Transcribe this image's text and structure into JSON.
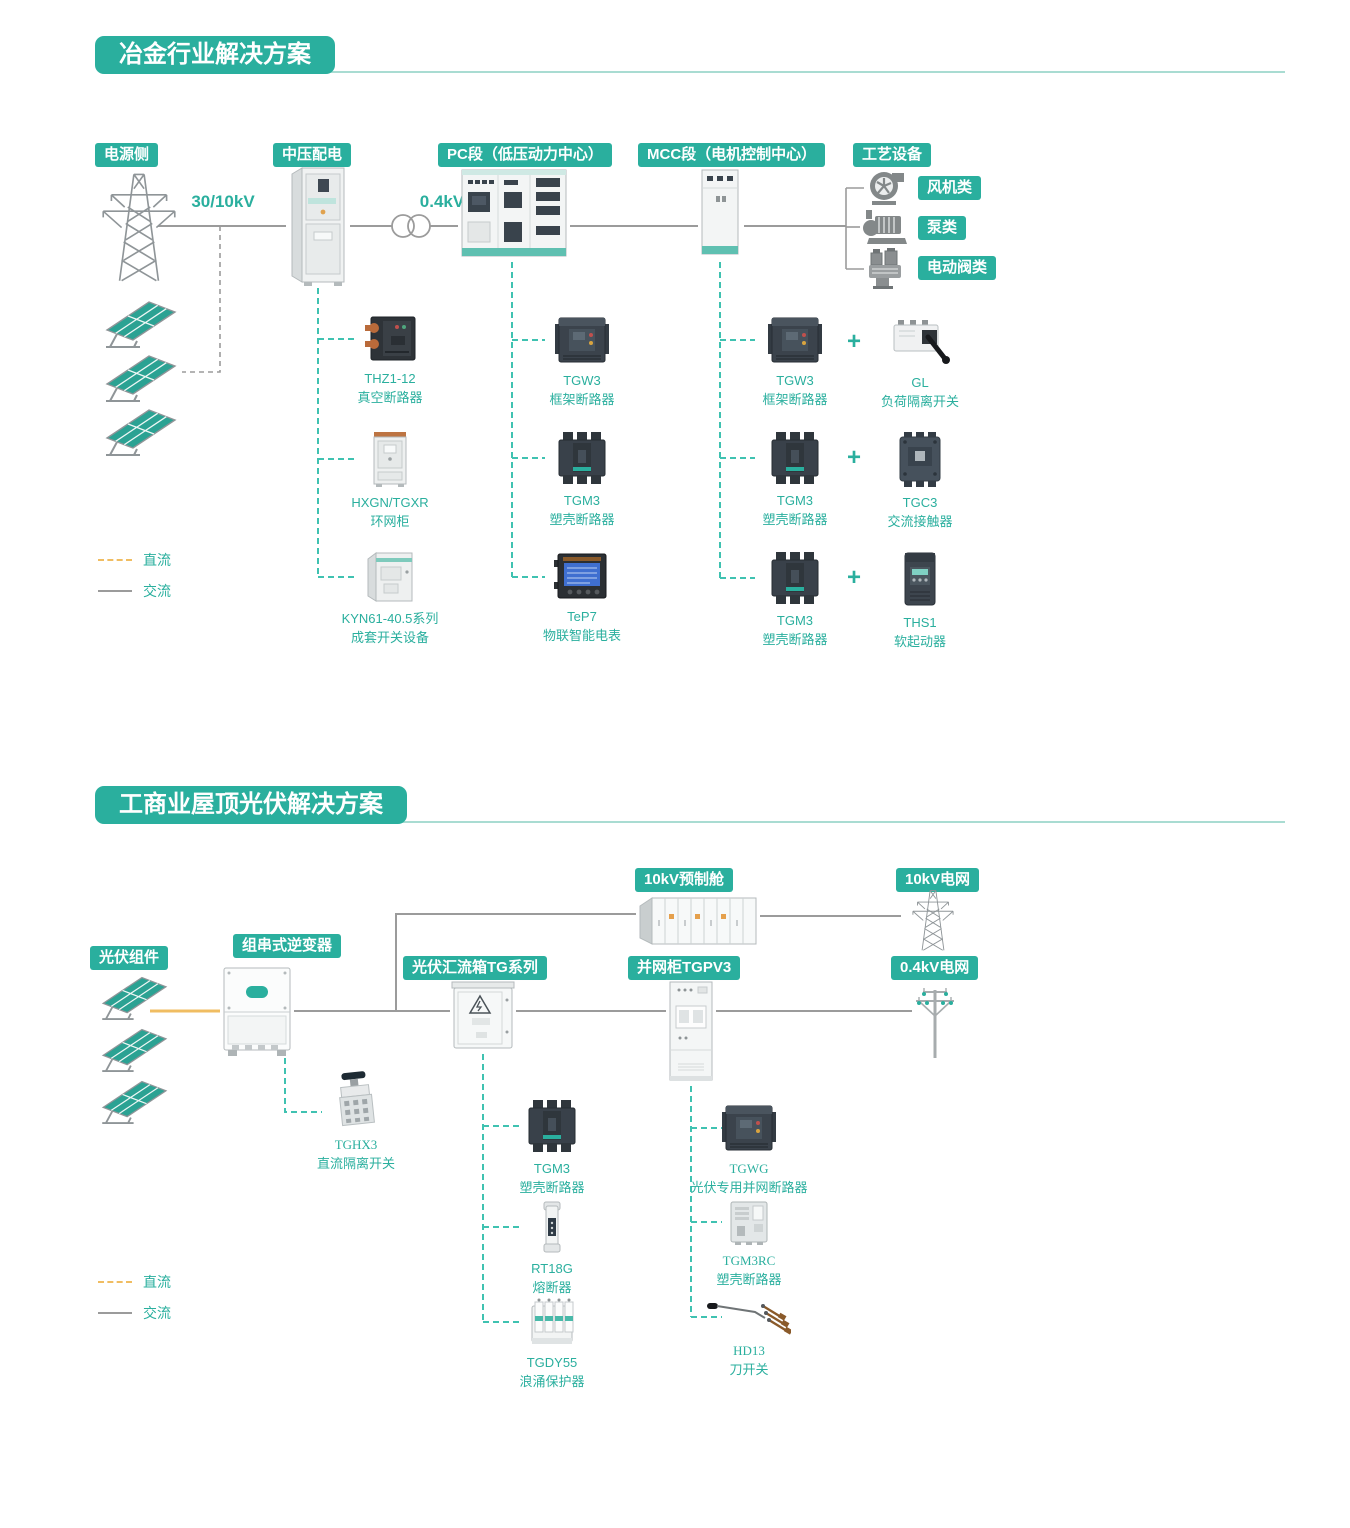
{
  "colors": {
    "brand_teal": "#2aaf9e",
    "dashed_teal": "#3fc2b1",
    "dc_orange": "#f0bd62",
    "ac_gray": "#9b9b9b"
  },
  "section1": {
    "title": "冶金行业解决方案",
    "headers": {
      "power_side": "电源侧",
      "mv_distribution": "中压配电",
      "pc_section": "PC段（低压动力中心）",
      "mcc_section": "MCC段（电机控制中心）",
      "process_equipment": "工艺设备"
    },
    "voltages": {
      "incoming": "30/10kV",
      "lv": "0.4kV"
    },
    "process_tags": [
      "风机类",
      "泵类",
      "电动阀类"
    ],
    "plus_sign": "+",
    "mv_components": [
      {
        "model": "THZ1-12",
        "name": "真空断路器"
      },
      {
        "model": "HXGN/TGXR",
        "name": "环网柜"
      },
      {
        "model": "KYN61-40.5系列",
        "name": "成套开关设备"
      }
    ],
    "pc_components": [
      {
        "model": "TGW3",
        "name": "框架断路器"
      },
      {
        "model": "TGM3",
        "name": "塑壳断路器"
      },
      {
        "model": "TeP7",
        "name": "物联智能电表"
      }
    ],
    "mcc_pairs": [
      {
        "left": {
          "model": "TGW3",
          "name": "框架断路器"
        },
        "right": {
          "model": "GL",
          "name": "负荷隔离开关"
        }
      },
      {
        "left": {
          "model": "TGM3",
          "name": "塑壳断路器"
        },
        "right": {
          "model": "TGC3",
          "name": "交流接触器"
        }
      },
      {
        "left": {
          "model": "TGM3",
          "name": "塑壳断路器"
        },
        "right": {
          "model": "THS1",
          "name": "软起动器"
        }
      }
    ],
    "legend": {
      "dc": "直流",
      "ac": "交流"
    }
  },
  "section2": {
    "title": "工商业屋顶光伏解决方案",
    "headers": {
      "pv_modules": "光伏组件",
      "string_inverter": "组串式逆变器",
      "combiner_box": "光伏汇流箱TG系列",
      "grid_cabinet": "并网柜TGPV3",
      "prefab_cabin": "10kV预制舱",
      "grid_10kv": "10kV电网",
      "grid_04kv": "0.4kV电网"
    },
    "inverter_component": {
      "model": "TGHX3",
      "name": "直流隔离开关"
    },
    "combiner_components": [
      {
        "model": "TGM3",
        "name": "塑壳断路器"
      },
      {
        "model": "RT18G",
        "name": "熔断器"
      },
      {
        "model": "TGDY55",
        "name": "浪涌保护器"
      }
    ],
    "grid_cabinet_components": [
      {
        "model": "TGWG",
        "name": "光伏专用并网断路器"
      },
      {
        "model": "TGM3RC",
        "name": "塑壳断路器"
      },
      {
        "model": "HD13",
        "name": "刀开关"
      }
    ],
    "legend": {
      "dc": "直流",
      "ac": "交流"
    }
  }
}
